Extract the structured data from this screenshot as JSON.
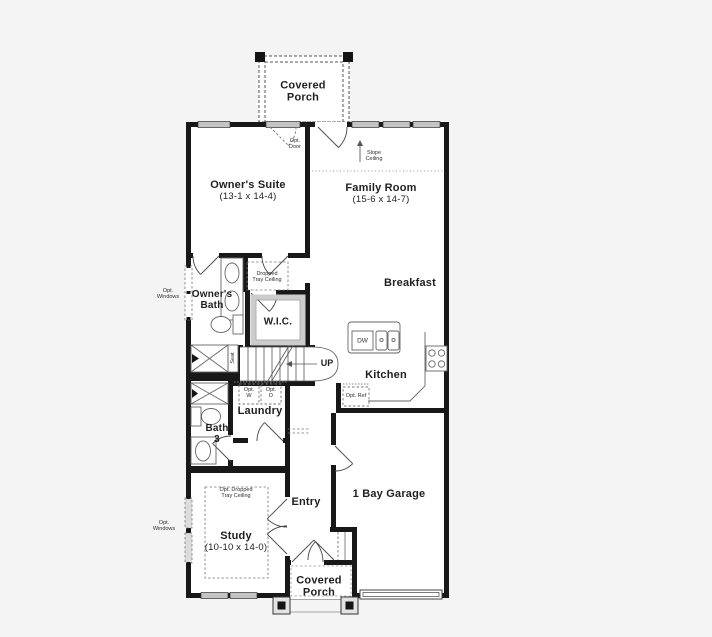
{
  "meta": {
    "type": "first-floor-plan",
    "bg_color": "#f4f4f5",
    "floor_color": "#ffffff",
    "wall_color": "#181818",
    "window_color": "#c4c4c4",
    "fixture_line_color": "#666666",
    "dash_color": "#8a8a8a",
    "text_color": "#1f1f1f"
  },
  "rooms": {
    "covered_porch_top": {
      "name": "Covered Porch"
    },
    "owners_suite": {
      "name": "Owner's Suite",
      "dims": "(13-1 x 14-4)"
    },
    "family_room": {
      "name": "Family Room",
      "dims": "(15-6 x 14-7)"
    },
    "breakfast": {
      "name": "Breakfast"
    },
    "owners_bath": {
      "name": "Owner's Bath"
    },
    "wic": {
      "name": "W.I.C."
    },
    "kitchen": {
      "name": "Kitchen"
    },
    "laundry": {
      "name": "Laundry"
    },
    "bath3": {
      "name": "Bath 3"
    },
    "entry": {
      "name": "Entry"
    },
    "garage": {
      "name": "1 Bay Garage"
    },
    "study": {
      "name": "Study",
      "dims": "(10-10 x 14-0)"
    },
    "covered_porch_bottom": {
      "name": "Covered Porch"
    }
  },
  "annotations": {
    "opt_door": "Opt. Door",
    "slope_ceiling": "Slope Ceiling",
    "dropped_tray_ceiling": "Dropped Tray Ceiling",
    "opt_windows_bath": "Opt. Windows",
    "opt_windows_study": "Opt. Windows",
    "opt_dropped_tray_ceiling": "Opt. Dropped Tray Ceiling",
    "seat": "Seat",
    "up": "UP",
    "dw": "DW",
    "opt_ref": "Opt. Ref",
    "opt_washer": "Opt. W",
    "opt_dryer": "Opt. D"
  }
}
